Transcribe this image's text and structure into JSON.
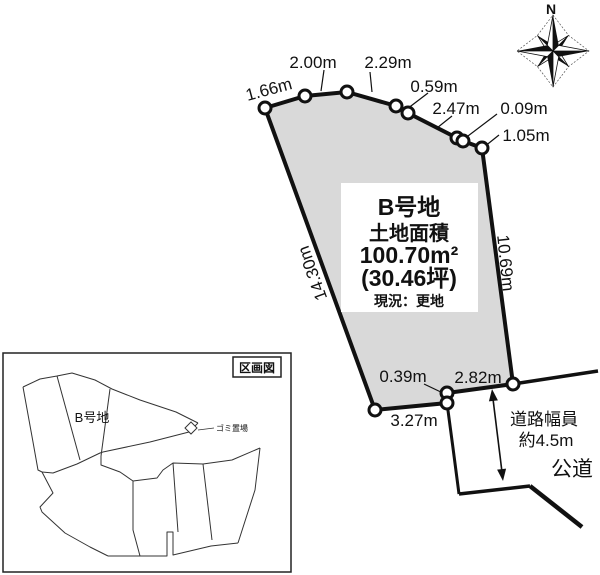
{
  "compass": {
    "north_label": "N"
  },
  "main_plot": {
    "name": "B号地",
    "area_title": "土地面積",
    "area_m2": "100.70m²",
    "area_tsubo": "(30.46坪)",
    "status": "現況：更地",
    "fill_color": "#d9d9d9"
  },
  "dimensions": {
    "top": [
      "1.66m",
      "2.00m",
      "2.29m",
      "0.59m",
      "2.47m",
      "0.09m",
      "1.05m"
    ],
    "left": "14.30m",
    "right": "10.69m",
    "bottom": [
      "3.27m",
      "0.39m",
      "2.82m"
    ]
  },
  "road": {
    "width_label": "道路幅員",
    "width_value": "約4.5m",
    "name": "公道"
  },
  "inset": {
    "title": "区画図",
    "plot_label": "B号地",
    "garbage_label": "ゴミ置場"
  }
}
